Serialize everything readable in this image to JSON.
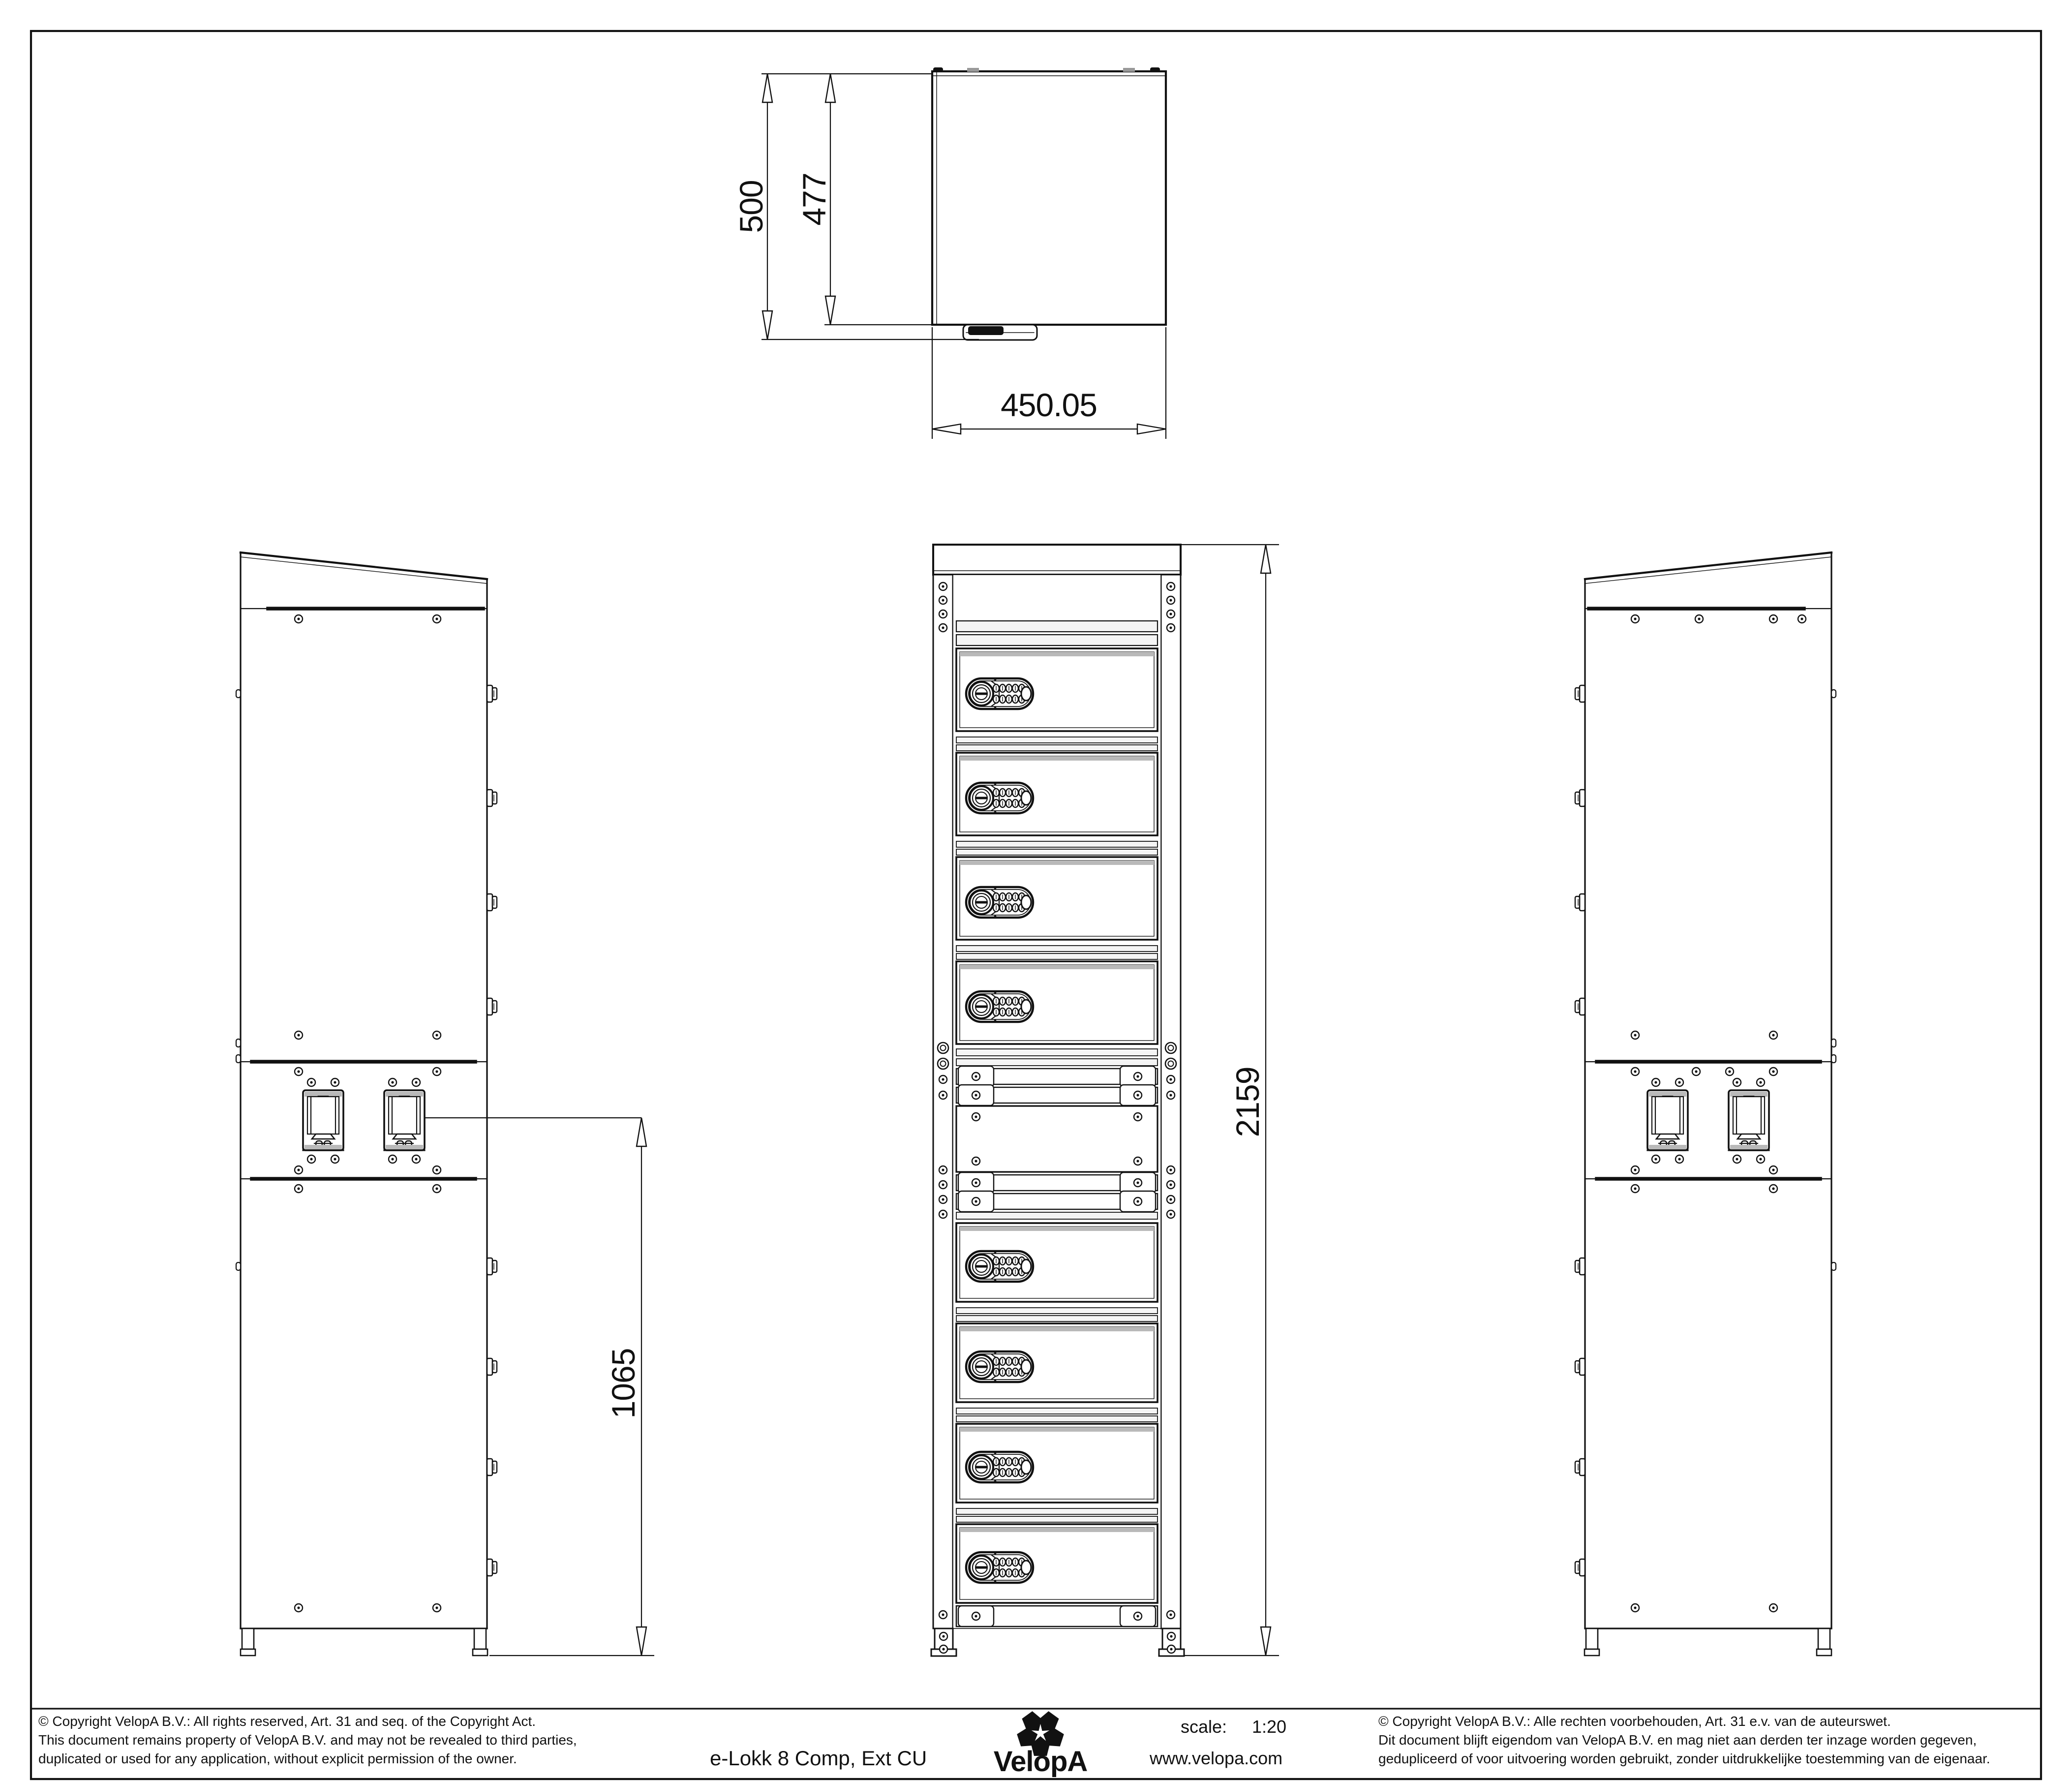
{
  "dimensions": {
    "depth": "500",
    "depth_inner": "477",
    "width": "450.05",
    "overall_height": "2159",
    "cu_height": "1065"
  },
  "title_block": {
    "title": "e-Lokk 8 Comp, Ext CU",
    "brand": "VelopA",
    "scale_label": "scale:",
    "scale_value": "1:20",
    "website": "www.velopa.com"
  },
  "copyright_en": {
    "line1": "©  Copyright VelopA B.V.: All rights reserved, Art. 31 and seq. of the Copyright Act.",
    "line2": "This document remains property of VelopA B.V. and may not be revealed to third parties,",
    "line3": "duplicated or used for any application, without explicit permission of the owner."
  },
  "copyright_nl": {
    "line1": "©  Copyright VelopA B.V.: Alle rechten voorbehouden, Art. 31 e.v. van de auteurswet.",
    "line2": "Dit document blijft eigendom van VelopA B.V. en mag niet aan derden ter inzage worden gegeven,",
    "line3": "gedupliceerd of voor uitvoering worden gebruikt, zonder uitdrukkelijke toestemming van de eigenaar."
  },
  "colors": {
    "line": "#111111",
    "paper": "#ffffff",
    "shade": "#b9b9b9"
  }
}
